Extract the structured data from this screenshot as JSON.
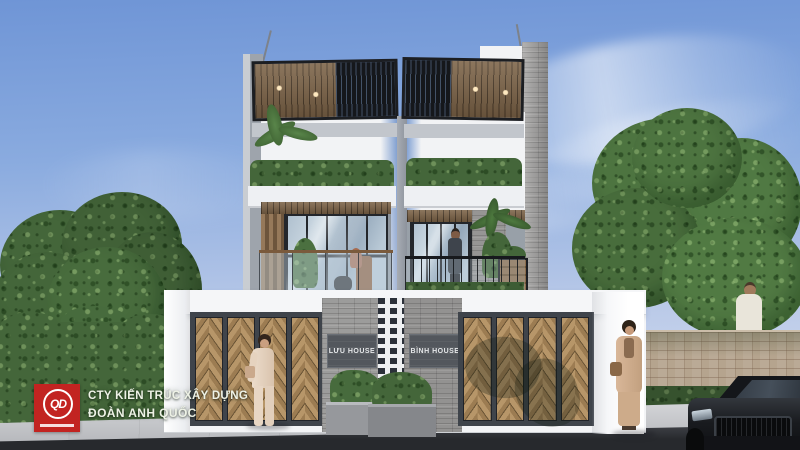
{
  "scene": {
    "title": "Twin modern townhouses - front elevation 3D render",
    "setting": "daytime, blue sky with cirrus clouds, trees on both sides, white boundary wall with wooden chevron gates, sidewalk and asphalt road in foreground"
  },
  "branding": {
    "logo_monogram": "QD",
    "logo_color": "#c22421",
    "company_line1": "CTY KIẾN TRÚC XÂY DỰNG",
    "company_line2": "ĐOÀN ANH QUỐC"
  },
  "houses": [
    {
      "name_plate": "LƯU HOUSE"
    },
    {
      "name_plate": "BÌNH HOUSE"
    }
  ],
  "palette": {
    "sky_top": "#6f95d6",
    "sky_bottom": "#dde4f1",
    "wall_white": "#f3f4f6",
    "concrete_gray": "#aeb3ba",
    "stone_gray": "#a3a2a1",
    "wood": "#a8895c",
    "gate_frame": "#3f444b",
    "foliage_dark": "#3d5c33",
    "foliage_light": "#537c43",
    "sidewalk": "#c9cbcf",
    "road": "#2d3034",
    "brick_wall": "#b5a48e",
    "car_black": "#17191d"
  }
}
